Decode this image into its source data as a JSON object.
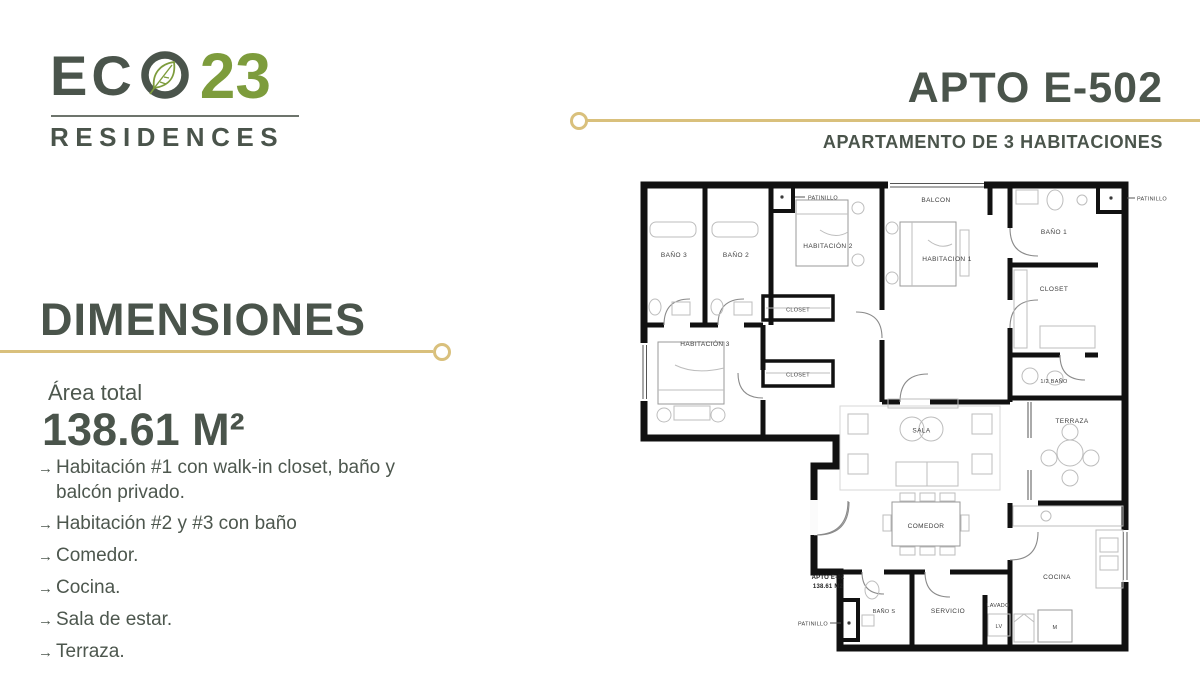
{
  "brand": {
    "name_eco": "ECO",
    "name_num": "23",
    "tagline": "RESIDENCES"
  },
  "header": {
    "title": "APTO E-502",
    "subtitle": "APARTAMENTO DE 3 HABITACIONES"
  },
  "dimensions": {
    "heading": "DIMENSIONES",
    "area_label": "Área total",
    "area_value": "138.61 M²",
    "bullet": "→",
    "features": [
      {
        "text": "Habitación #1 con walk-in closet, baño y balcón privado."
      },
      {
        "text": "Habitación #2 y #3 con baño"
      },
      {
        "text": "Comedor."
      },
      {
        "text": "Cocina."
      },
      {
        "text": "Sala de estar."
      },
      {
        "text": "Terraza."
      }
    ]
  },
  "floorplan": {
    "patinillo": "PATINILLO",
    "bano3": "BAÑO 3",
    "bano2": "BAÑO 2",
    "bano1": "BAÑO 1",
    "hab1": "HABITACION 1",
    "hab2": "HABITACIÓN 2",
    "hab3": "HABITACIÓN 3",
    "closet": "CLOSET",
    "balcon": "BALCON",
    "half_bano": "1/2 BAÑO",
    "sala": "SALA",
    "comedor": "COMEDOR",
    "cocina": "COCINA",
    "terraza": "TERRAZA",
    "bano_s": "BAÑO S",
    "servicio": "SERVICIO",
    "lavado": "LAVADO",
    "lv": "LV",
    "m_label": "M",
    "apto_line1": "APTO E-02",
    "apto_line2": "138.61 M2"
  },
  "colors": {
    "text_dark": "#4a544b",
    "brand_green": "#7d9c3c",
    "accent_gold": "#d9c07c"
  }
}
